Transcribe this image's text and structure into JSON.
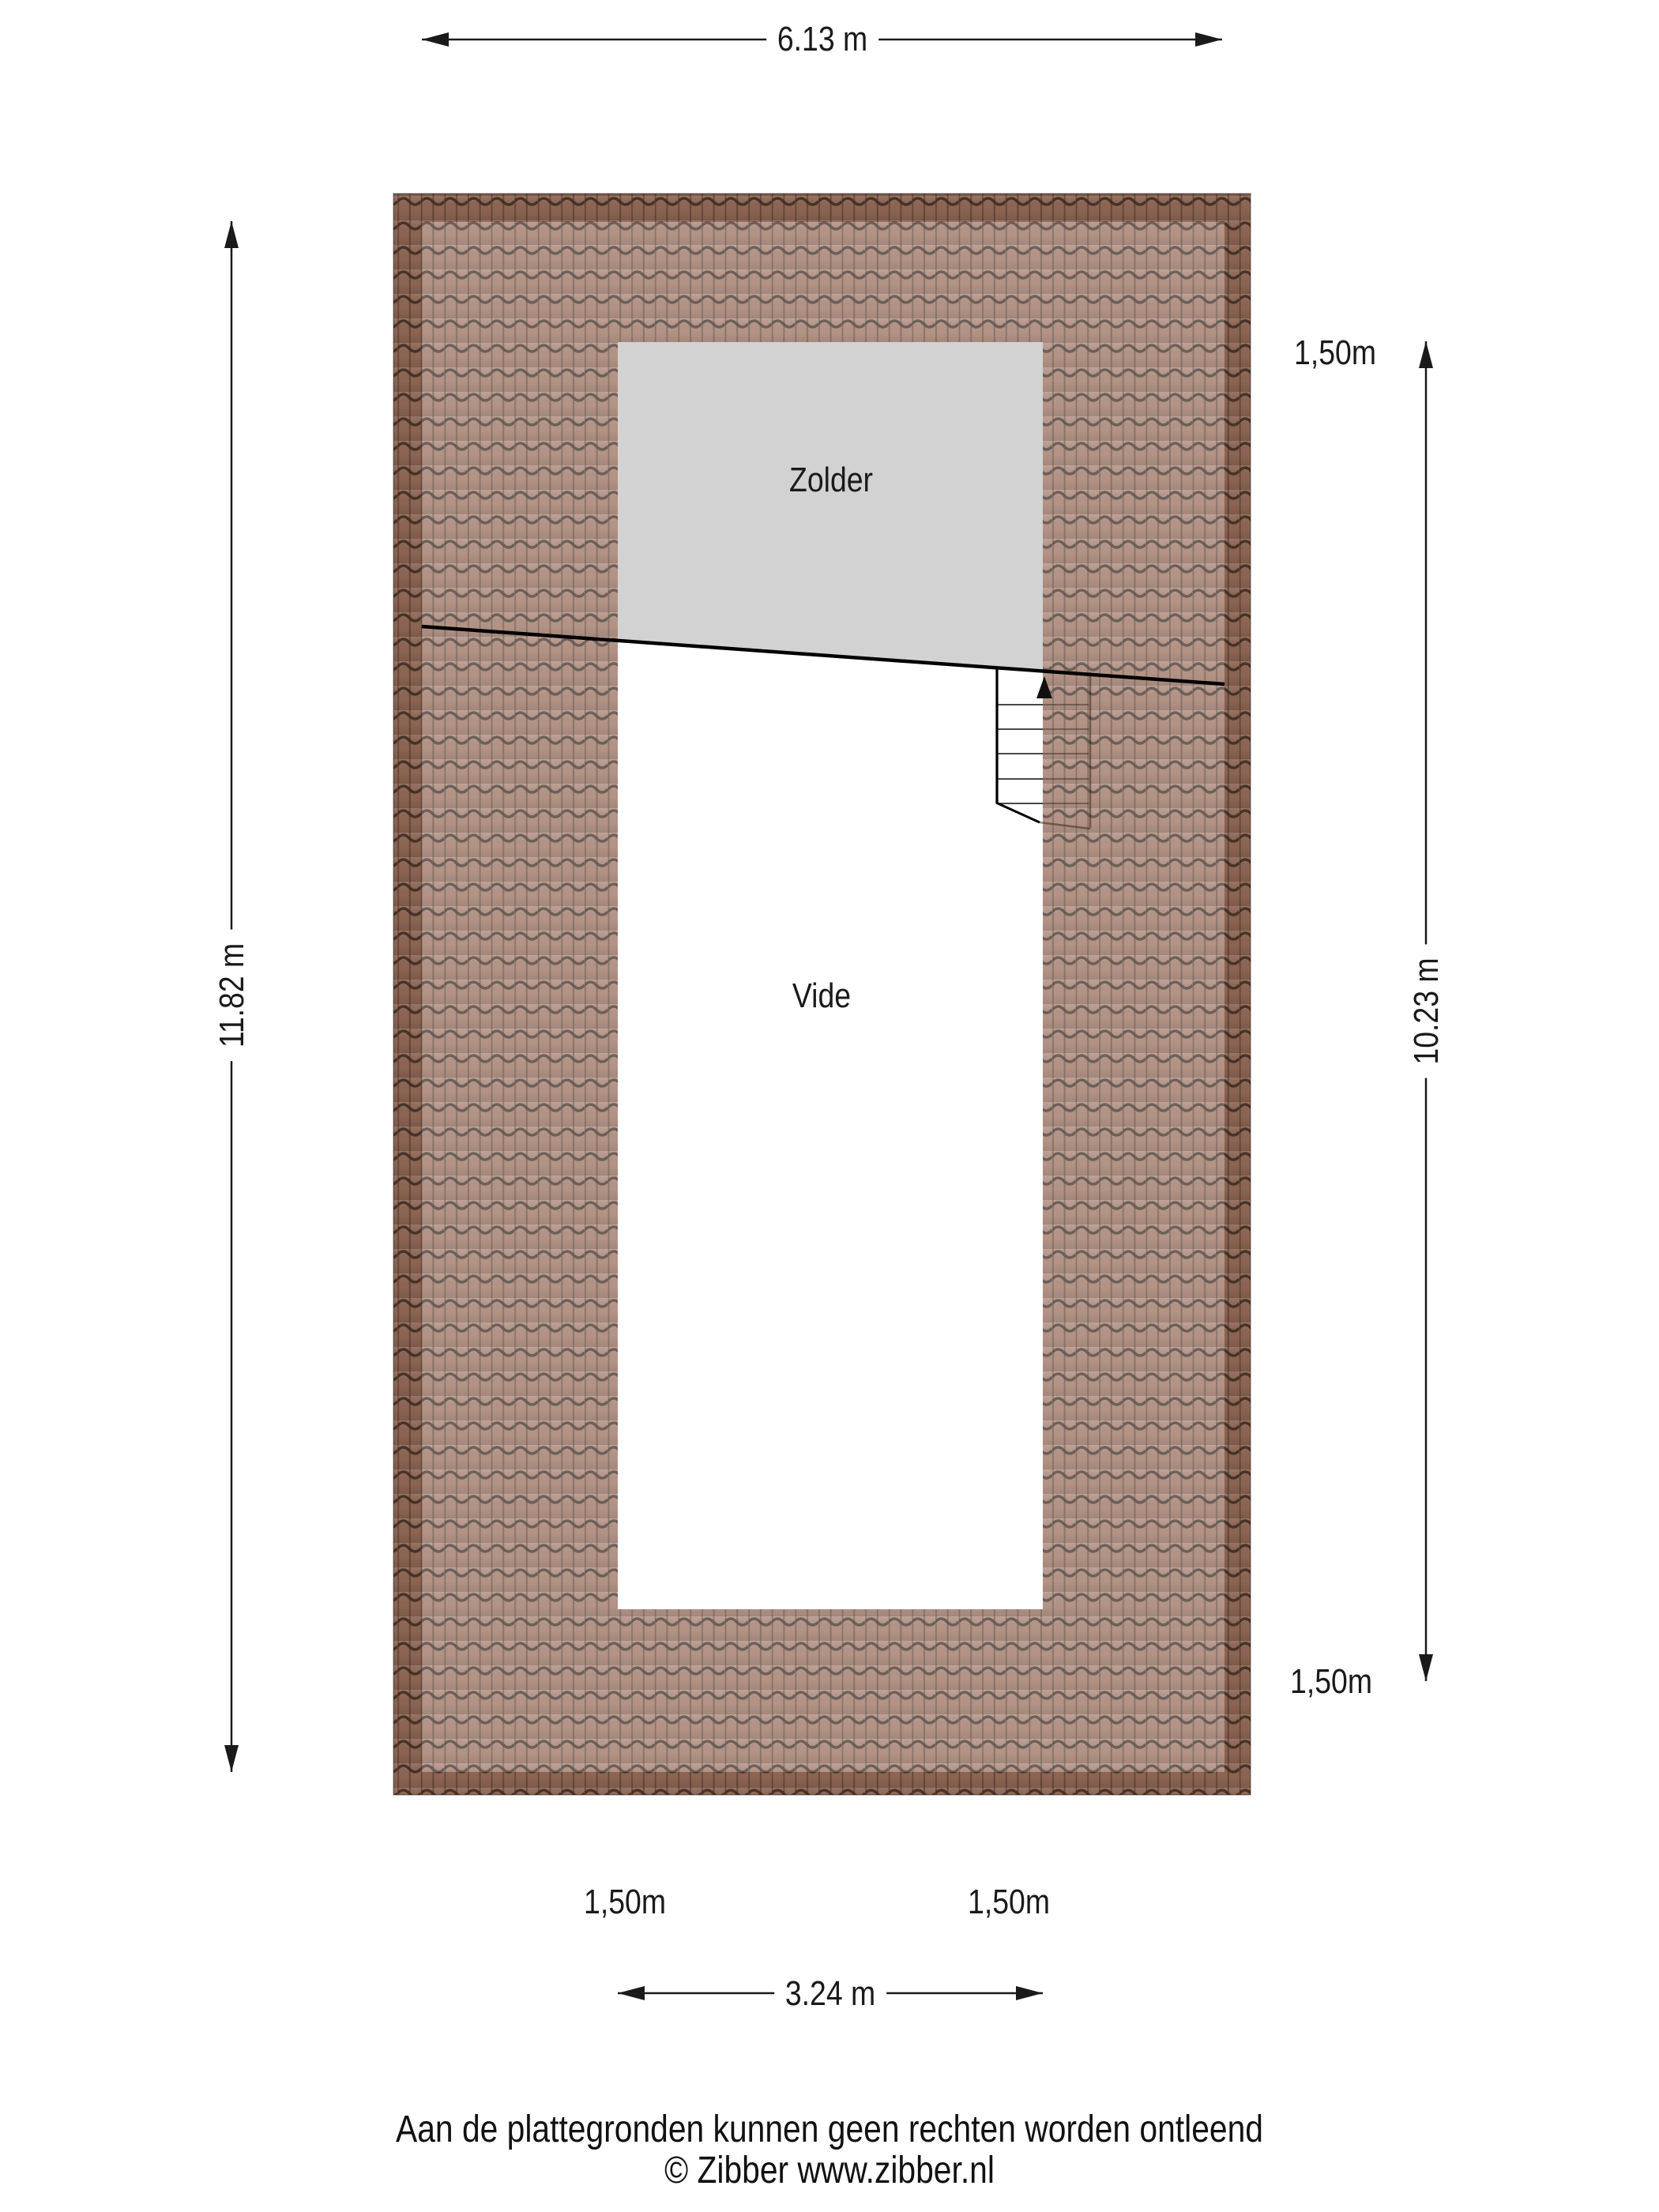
{
  "plan": {
    "rooms": {
      "zolder": "Zolder",
      "vide": "Vide"
    }
  },
  "dimensions": {
    "top_width": "6.13 m",
    "left_height": "11.82 m",
    "right_height": "10.23 m",
    "bottom_width": "3.24 m"
  },
  "height_lines": {
    "right_top": "1,50m",
    "right_bottom": "1,50m",
    "bottom_left": "1,50m",
    "bottom_right": "1,50m"
  },
  "footer": {
    "disclaimer": "Aan de plattegronden kunnen geen rechten worden ontleend",
    "copyright": "© Zibber www.zibber.nl"
  },
  "colors": {
    "roof_tile_base": "#a47b69",
    "roof_tile_line": "#3a2d26",
    "zolder_fill": "#d2d2d2",
    "vide_fill": "#ffffff",
    "line_color": "#1a1a1a"
  }
}
